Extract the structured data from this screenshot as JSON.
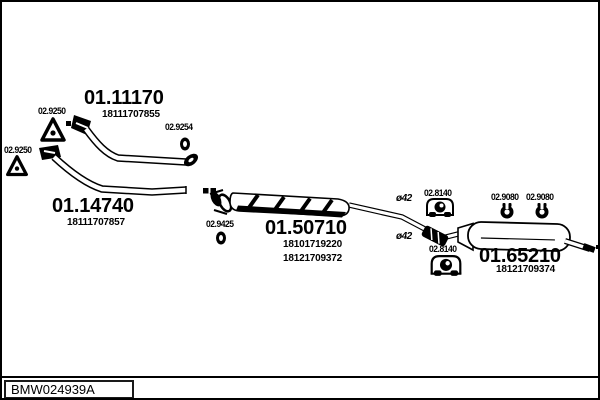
{
  "diagram": {
    "footer_code": "BMW024939A",
    "colors": {
      "line": "#000000",
      "background": "#ffffff"
    },
    "parts": [
      {
        "id": "front-pipe-upper",
        "number": "01.11170",
        "oem": [
          "18111707855"
        ]
      },
      {
        "id": "front-pipe-lower",
        "number": "01.14740",
        "oem": [
          "18111707857"
        ]
      },
      {
        "id": "centre-silencer",
        "number": "01.50710",
        "oem": [
          "18101719220",
          "18121709372"
        ]
      },
      {
        "id": "rear-silencer",
        "number": "01.65210",
        "oem": [
          "18121709374"
        ]
      }
    ],
    "fittings": [
      {
        "id": "gasket-top",
        "label": "02.9250",
        "icon": "triangle-gasket-icon"
      },
      {
        "id": "gasket-left",
        "label": "02.9250",
        "icon": "triangle-gasket-icon"
      },
      {
        "id": "seal-ring-front",
        "label": "02.9254",
        "icon": "seal-ring-icon"
      },
      {
        "id": "seal-ring-centre",
        "label": "02.9425",
        "icon": "seal-ring-icon"
      },
      {
        "id": "hanger-upper",
        "label": "02.8140",
        "icon": "rubber-hanger-icon"
      },
      {
        "id": "hanger-lower",
        "label": "02.8140",
        "icon": "rubber-hanger-icon"
      },
      {
        "id": "clamp-left",
        "label": "02.9080",
        "icon": "clamp-ring-icon"
      },
      {
        "id": "clamp-right",
        "label": "02.9080",
        "icon": "clamp-ring-icon"
      }
    ],
    "annotations": [
      {
        "id": "pipe-diameter-upper",
        "label": "ø42"
      },
      {
        "id": "pipe-diameter-lower",
        "label": "ø42"
      }
    ]
  }
}
